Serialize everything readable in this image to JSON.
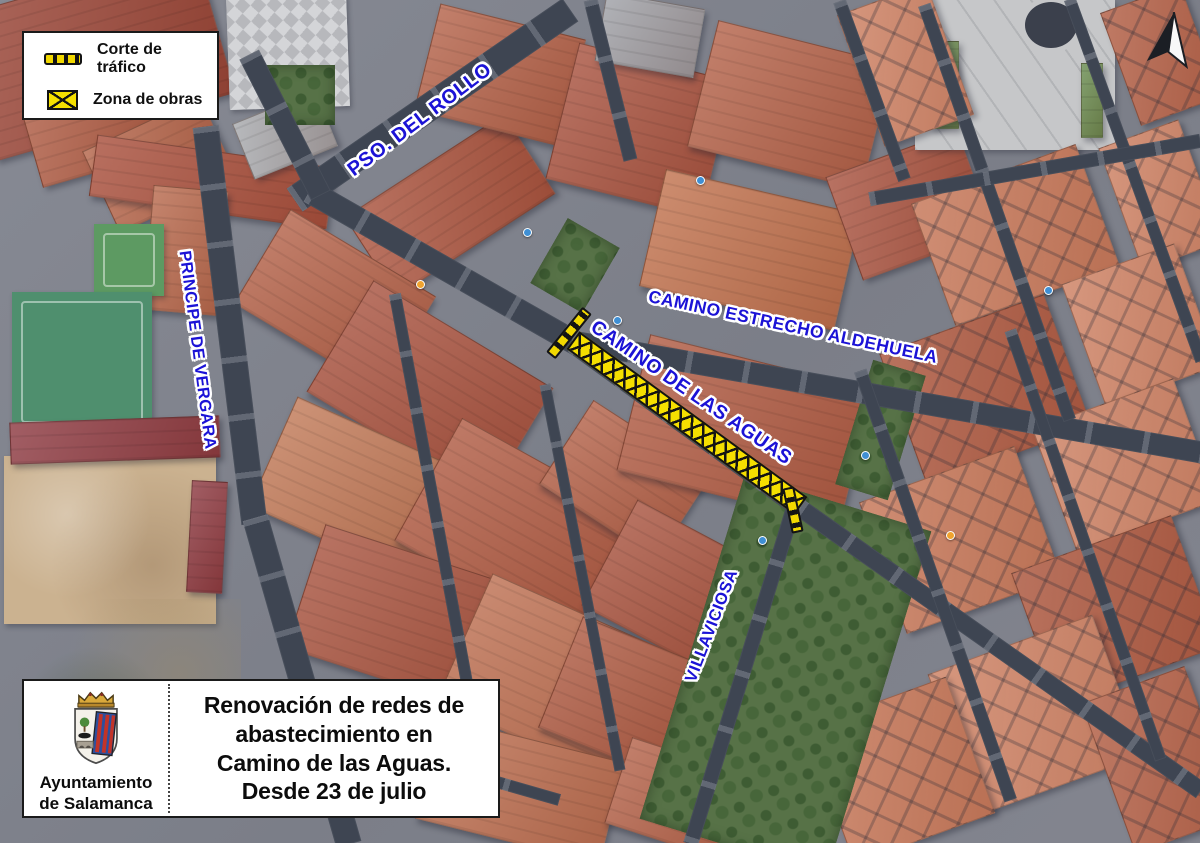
{
  "legend": {
    "items": [
      {
        "id": "traffic-cut",
        "label": "Corte de tráfico"
      },
      {
        "id": "work-zone",
        "label": "Zona de obras"
      }
    ]
  },
  "streets": [
    {
      "id": "pso-del-rollo",
      "text": "PSO. DEL ROLLO"
    },
    {
      "id": "principe-de-vergara",
      "text": "PRINCIPE DE VERGARA"
    },
    {
      "id": "camino-estrecho-aldehuela",
      "text": "CAMINO ESTRECHO ALDEHUELA"
    },
    {
      "id": "camino-de-las-aguas",
      "text": "CAMINO DE LAS AGUAS"
    },
    {
      "id": "villaviciosa",
      "text": "VILLAVICIOSA"
    }
  ],
  "info": {
    "org": [
      "Ayuntamiento",
      "de Salamanca"
    ],
    "notice": [
      "Renovación de redes de",
      "abastecimiento en",
      "Camino de las Aguas.",
      "Desde 23 de julio"
    ]
  },
  "icons": {
    "traffic_cut": "dashed-yellow-on-black-bar",
    "work_zone": "yellow-crosshatch-box",
    "north_arrow": "compass-north-arrow",
    "crest": "salamanca-coat-of-arms"
  },
  "colors": {
    "street_label_blue": "#1b12d6",
    "works_yellow": "#f5df00",
    "hatch_black": "#131313",
    "legend_bg": "#ffffff",
    "border_black": "#1a1a1a"
  }
}
